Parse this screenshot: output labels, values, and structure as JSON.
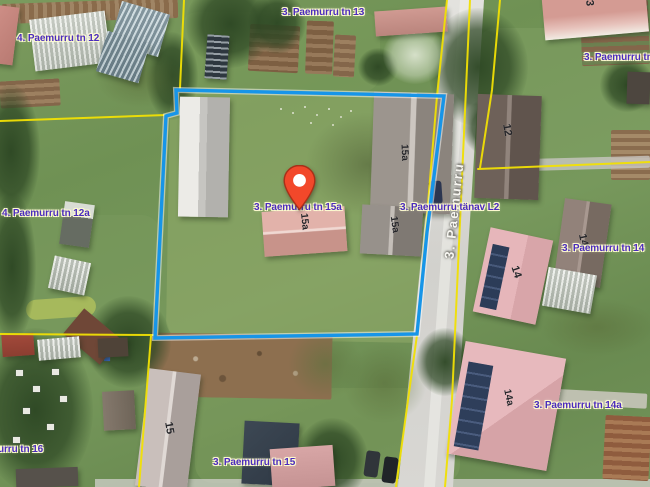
{
  "map": {
    "kind": "aerial cadastral map with selected parcel",
    "selected_parcel": "3. Paemurru tn 15a",
    "street_label": "3. Paemurru",
    "labels": [
      {
        "text": "4. Paemurru tn 12"
      },
      {
        "text": "3. Paemurru tn 13"
      },
      {
        "text": "3. Paemurru tn"
      },
      {
        "text": "4. Paemurru tn 12a"
      },
      {
        "text": "3. Paemurru tn 15a"
      },
      {
        "text": "3. Paemurru tänav L2"
      },
      {
        "text": "3. Paemurru tn 14"
      },
      {
        "text": "3. Paemurru tn 14a"
      },
      {
        "text": "3. Paemurru tn 15"
      },
      {
        "text": "urru tn 16"
      }
    ],
    "building_numbers": [
      {
        "text": "13"
      },
      {
        "text": "12"
      },
      {
        "text": "15a"
      },
      {
        "text": "15a"
      },
      {
        "text": "15a"
      },
      {
        "text": "14"
      },
      {
        "text": "14"
      },
      {
        "text": "14a"
      },
      {
        "text": "15"
      }
    ],
    "colors": {
      "cadastral_line": "#f1e004",
      "selected_outline": "#1795e8",
      "label_text": "#4a2bbd",
      "pin_fill": "#f2482a",
      "road_surface": "#dddcd7"
    }
  }
}
